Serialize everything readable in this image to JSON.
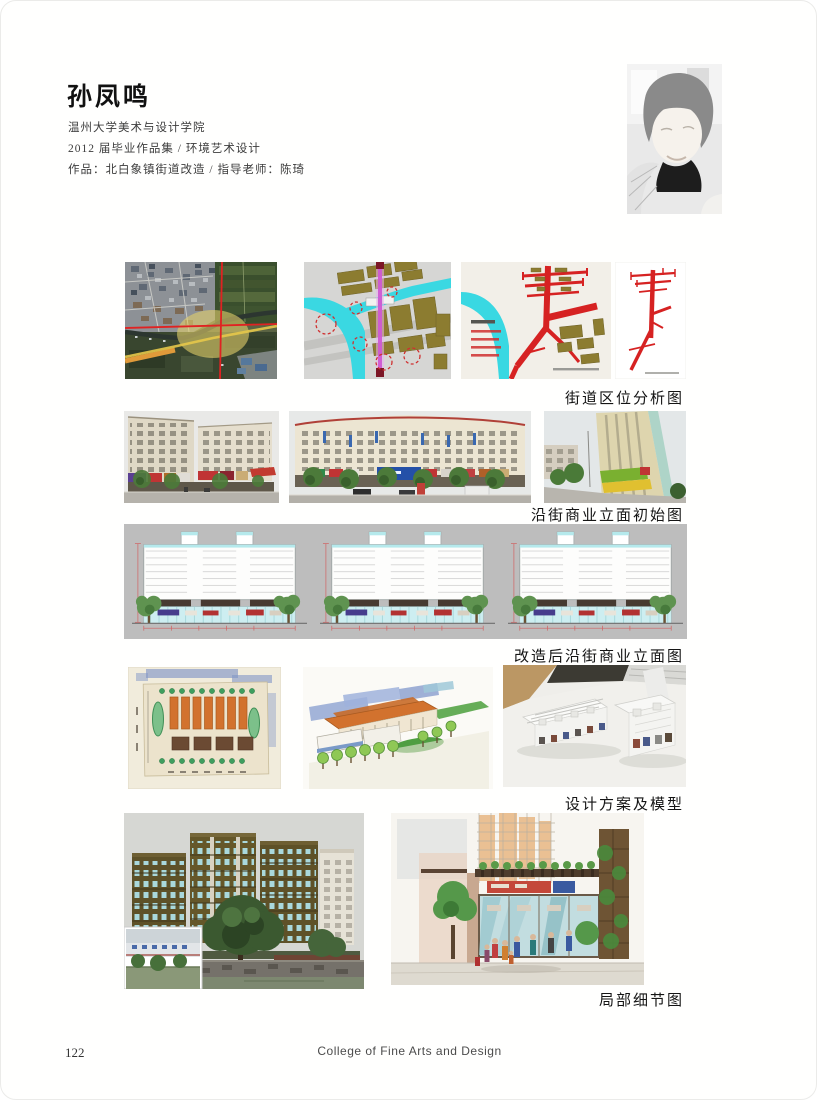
{
  "header": {
    "name": "孙凤鸣",
    "school": "温州大学美术与设计学院",
    "edition": "2012 届毕业作品集 / 环境艺术设计",
    "work_line": "作品：北白象镇街道改造 / 指导老师：陈琦"
  },
  "figures": [
    {
      "id": "site-analysis",
      "caption": "街道区位分析图"
    },
    {
      "id": "street-initial",
      "caption": "沿街商业立面初始图"
    },
    {
      "id": "street-renovated",
      "caption": "改造后沿街商业立面图"
    },
    {
      "id": "scheme-model",
      "caption": "设计方案及模型"
    },
    {
      "id": "detail-views",
      "caption": "局部细节图"
    }
  ],
  "footer": {
    "page_number": "122",
    "college_name": "College of Fine Arts and Design"
  },
  "palette": {
    "river_cyan": "#39d8e2",
    "road_red": "#d62222",
    "block_olive": "#8c7c30",
    "road_magenta": "#cf5ad2",
    "elevation_strip_gray": "#bdbdbd"
  }
}
